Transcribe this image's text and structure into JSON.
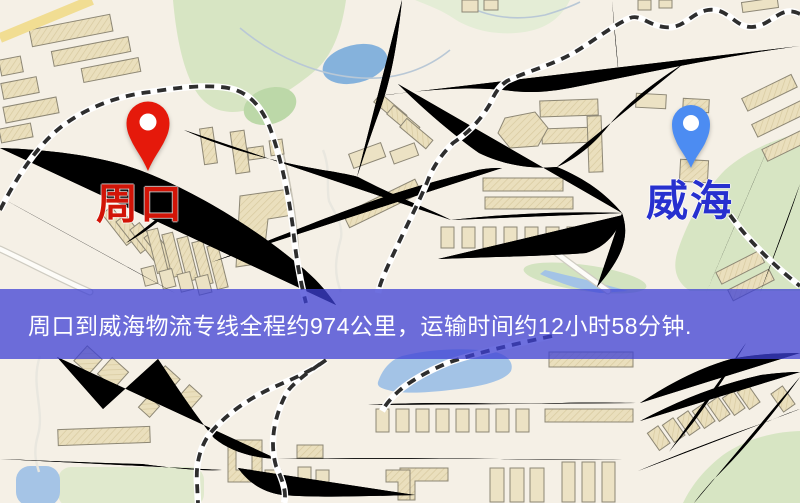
{
  "map": {
    "kind": "logistics-route-map",
    "origin": {
      "label": "周口",
      "pin_color": "#e5190b",
      "label_color": "#d21407"
    },
    "destination": {
      "label": "威海",
      "pin_color": "#4c8cf2",
      "label_color": "#2730cf"
    },
    "banner": {
      "text": "周口到威海物流专线全程约974公里，运输时间约12小时58分钟.",
      "distance_km": 974,
      "duration": "12小时58分钟",
      "background": "rgba(62,64,212,0.75)",
      "text_color": "#ffffff"
    },
    "palette": {
      "background": "#f5f0e6",
      "road_fill": "#f6d57a",
      "road_casing": "#e3ac55",
      "water": "#9dc0e6",
      "park": "#d7e5c3",
      "building": "#eadfbd",
      "railway": "#2e2e2e"
    }
  }
}
